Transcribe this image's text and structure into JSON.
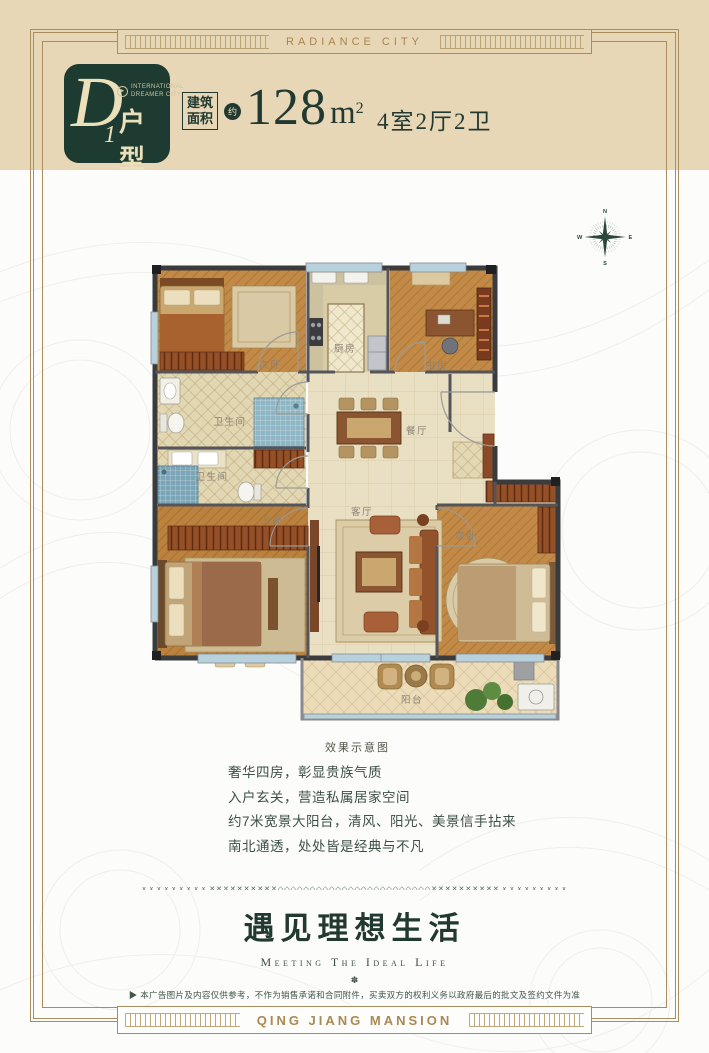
{
  "banner": {
    "top": "RADIANCE CITY",
    "bottom": "QING JIANG MANSION"
  },
  "header": {
    "badge": {
      "letter": "D",
      "number": "1",
      "suffix": "户型",
      "brand_icon": "▶",
      "brand_line1": "INTERNATIONAL",
      "brand_line2": "DREAMER CITY"
    },
    "area_label_1": "建筑",
    "area_label_2": "面积",
    "approx": "约",
    "area_value": "128",
    "area_unit_base": "m",
    "area_unit_sup": "2",
    "rooms_spec": "4室2厅2卫"
  },
  "floorplan": {
    "caption": "效果示意图",
    "labels": {
      "bedroom_top": "次卧",
      "kitchen": "厨房",
      "study": "书房",
      "bath1": "卫生间",
      "bath2": "卫生间",
      "dining": "餐厅",
      "living": "客厅",
      "master": "主卧",
      "bedroom_bottom": "次卧",
      "balcony": "阳台"
    },
    "compass": {
      "n": "N",
      "e": "E",
      "s": "S",
      "w": "W"
    }
  },
  "features": {
    "lines": [
      "奢华四房，彰显贵族气质",
      "入户玄关，营造私属居家空间",
      "约7米宽景大阳台，清风、阳光、美景信手拈来",
      "南北通透，处处皆是经典与不凡"
    ]
  },
  "divider": {
    "pattern": "x x x x x x x x x ✕✕✕✕✕✕✕✕✕✕◇◇◇◇◇◇◇◇◇◇◇◇◇◇◇◇◇◇◇◇◇◇◇◇✕✕✕✕✕✕✕✕✕✕ x x x x x x x x x"
  },
  "slogan": {
    "cn": "遇见理想生活",
    "en": "Meeting The Ideal Life",
    "ornament": "✽"
  },
  "disclaimer": "▶ 本广告图片及内容仅供参考，不作为销售承诺和合同附件，买卖双方的权利义务以政府最后的批文及签约文件为准",
  "colors": {
    "tan": "#e7d7b6",
    "frame_gold": "#a98d5e",
    "deep_green": "#1d3b31",
    "gold_text": "#aa8952",
    "text_green": "#223931",
    "wall_dark": "#3a3b3d"
  }
}
